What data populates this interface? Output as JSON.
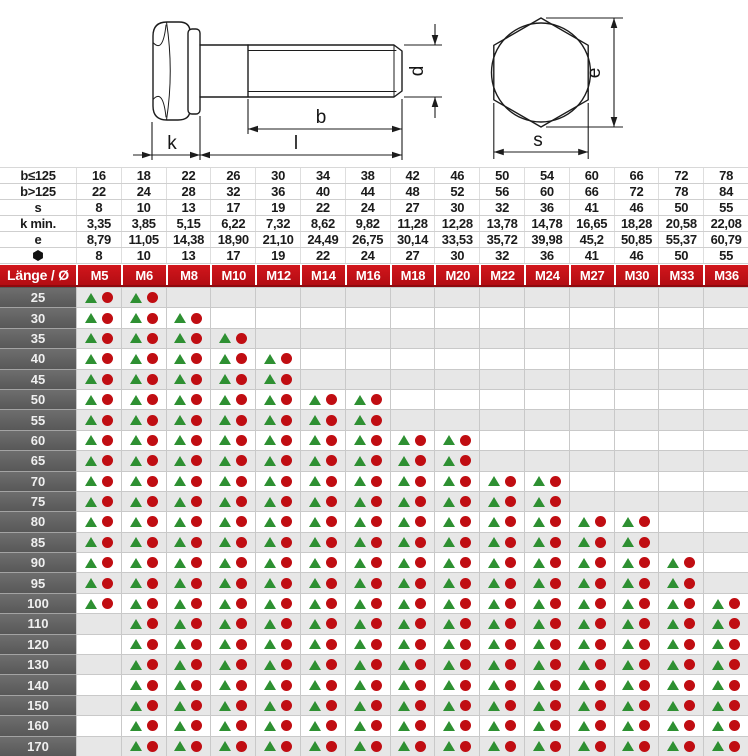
{
  "drawing": {
    "labels": {
      "d": "d",
      "b": "b",
      "l": "l",
      "k": "k",
      "e": "e",
      "s": "s"
    }
  },
  "spec_table": {
    "rows": [
      {
        "label": "b≤125",
        "icon": null,
        "values": [
          "16",
          "18",
          "22",
          "26",
          "30",
          "34",
          "38",
          "42",
          "46",
          "50",
          "54",
          "60",
          "66",
          "72",
          "78"
        ]
      },
      {
        "label": "b>125",
        "icon": null,
        "values": [
          "22",
          "24",
          "28",
          "32",
          "36",
          "40",
          "44",
          "48",
          "52",
          "56",
          "60",
          "66",
          "72",
          "78",
          "84"
        ]
      },
      {
        "label": "s",
        "icon": null,
        "values": [
          "8",
          "10",
          "13",
          "17",
          "19",
          "22",
          "24",
          "27",
          "30",
          "32",
          "36",
          "41",
          "46",
          "50",
          "55"
        ]
      },
      {
        "label": "k min.",
        "icon": null,
        "values": [
          "3,35",
          "3,85",
          "5,15",
          "6,22",
          "7,32",
          "8,62",
          "9,82",
          "11,28",
          "12,28",
          "13,78",
          "14,78",
          "16,65",
          "18,28",
          "20,58",
          "22,08"
        ]
      },
      {
        "label": "e",
        "icon": null,
        "values": [
          "8,79",
          "11,05",
          "14,38",
          "18,90",
          "21,10",
          "24,49",
          "26,75",
          "30,14",
          "33,53",
          "35,72",
          "39,98",
          "45,2",
          "50,85",
          "55,37",
          "60,79"
        ]
      },
      {
        "label": "",
        "icon": "hex-nut-icon",
        "values": [
          "8",
          "10",
          "13",
          "17",
          "19",
          "22",
          "24",
          "27",
          "30",
          "32",
          "36",
          "41",
          "46",
          "50",
          "55"
        ]
      }
    ]
  },
  "matrix": {
    "corner_label": "Länge / Ø",
    "columns": [
      "M5",
      "M6",
      "M8",
      "M10",
      "M12",
      "M14",
      "M16",
      "M18",
      "M20",
      "M22",
      "M24",
      "M27",
      "M30",
      "M33",
      "M36"
    ],
    "cell_symbols": [
      "triangle",
      "circle"
    ],
    "rows": [
      {
        "length": "25",
        "available": [
          "M5",
          "M6"
        ]
      },
      {
        "length": "30",
        "available": [
          "M5",
          "M6",
          "M8"
        ]
      },
      {
        "length": "35",
        "available": [
          "M5",
          "M6",
          "M8",
          "M10"
        ]
      },
      {
        "length": "40",
        "available": [
          "M5",
          "M6",
          "M8",
          "M10",
          "M12"
        ]
      },
      {
        "length": "45",
        "available": [
          "M5",
          "M6",
          "M8",
          "M10",
          "M12"
        ]
      },
      {
        "length": "50",
        "available": [
          "M5",
          "M6",
          "M8",
          "M10",
          "M12",
          "M14",
          "M16"
        ]
      },
      {
        "length": "55",
        "available": [
          "M5",
          "M6",
          "M8",
          "M10",
          "M12",
          "M14",
          "M16"
        ]
      },
      {
        "length": "60",
        "available": [
          "M5",
          "M6",
          "M8",
          "M10",
          "M12",
          "M14",
          "M16",
          "M18",
          "M20"
        ]
      },
      {
        "length": "65",
        "available": [
          "M5",
          "M6",
          "M8",
          "M10",
          "M12",
          "M14",
          "M16",
          "M18",
          "M20"
        ]
      },
      {
        "length": "70",
        "available": [
          "M5",
          "M6",
          "M8",
          "M10",
          "M12",
          "M14",
          "M16",
          "M18",
          "M20",
          "M22",
          "M24"
        ]
      },
      {
        "length": "75",
        "available": [
          "M5",
          "M6",
          "M8",
          "M10",
          "M12",
          "M14",
          "M16",
          "M18",
          "M20",
          "M22",
          "M24"
        ]
      },
      {
        "length": "80",
        "available": [
          "M5",
          "M6",
          "M8",
          "M10",
          "M12",
          "M14",
          "M16",
          "M18",
          "M20",
          "M22",
          "M24",
          "M27",
          "M30"
        ]
      },
      {
        "length": "85",
        "available": [
          "M5",
          "M6",
          "M8",
          "M10",
          "M12",
          "M14",
          "M16",
          "M18",
          "M20",
          "M22",
          "M24",
          "M27",
          "M30"
        ]
      },
      {
        "length": "90",
        "available": [
          "M5",
          "M6",
          "M8",
          "M10",
          "M12",
          "M14",
          "M16",
          "M18",
          "M20",
          "M22",
          "M24",
          "M27",
          "M30",
          "M33"
        ]
      },
      {
        "length": "95",
        "available": [
          "M5",
          "M6",
          "M8",
          "M10",
          "M12",
          "M14",
          "M16",
          "M18",
          "M20",
          "M22",
          "M24",
          "M27",
          "M30",
          "M33"
        ]
      },
      {
        "length": "100",
        "available": [
          "M5",
          "M6",
          "M8",
          "M10",
          "M12",
          "M14",
          "M16",
          "M18",
          "M20",
          "M22",
          "M24",
          "M27",
          "M30",
          "M33",
          "M36"
        ]
      },
      {
        "length": "110",
        "available": [
          "M6",
          "M8",
          "M10",
          "M12",
          "M14",
          "M16",
          "M18",
          "M20",
          "M22",
          "M24",
          "M27",
          "M30",
          "M33",
          "M36"
        ]
      },
      {
        "length": "120",
        "available": [
          "M6",
          "M8",
          "M10",
          "M12",
          "M14",
          "M16",
          "M18",
          "M20",
          "M22",
          "M24",
          "M27",
          "M30",
          "M33",
          "M36"
        ]
      },
      {
        "length": "130",
        "available": [
          "M6",
          "M8",
          "M10",
          "M12",
          "M14",
          "M16",
          "M18",
          "M20",
          "M22",
          "M24",
          "M27",
          "M30",
          "M33",
          "M36"
        ]
      },
      {
        "length": "140",
        "available": [
          "M6",
          "M8",
          "M10",
          "M12",
          "M14",
          "M16",
          "M18",
          "M20",
          "M22",
          "M24",
          "M27",
          "M30",
          "M33",
          "M36"
        ]
      },
      {
        "length": "150",
        "available": [
          "M6",
          "M8",
          "M10",
          "M12",
          "M14",
          "M16",
          "M18",
          "M20",
          "M22",
          "M24",
          "M27",
          "M30",
          "M33",
          "M36"
        ]
      },
      {
        "length": "160",
        "available": [
          "M6",
          "M8",
          "M10",
          "M12",
          "M14",
          "M16",
          "M18",
          "M20",
          "M22",
          "M24",
          "M27",
          "M30",
          "M33",
          "M36"
        ]
      },
      {
        "length": "170",
        "available": [
          "M6",
          "M8",
          "M10",
          "M12",
          "M14",
          "M16",
          "M18",
          "M20",
          "M22",
          "M24",
          "M27",
          "M30",
          "M33",
          "M36"
        ]
      }
    ]
  },
  "colors": {
    "header_red": "#c81016",
    "header_red_dark": "#8e0a0e",
    "row_label_gray": "#6e6e6e",
    "row_label_gray_dark": "#585858",
    "stripe_gray": "#e7e7e7",
    "triangle_green": "#2e9032",
    "circle_red": "#c00d12",
    "grid_line": "#c9c9c9",
    "line_color": "#1c1c1c"
  }
}
